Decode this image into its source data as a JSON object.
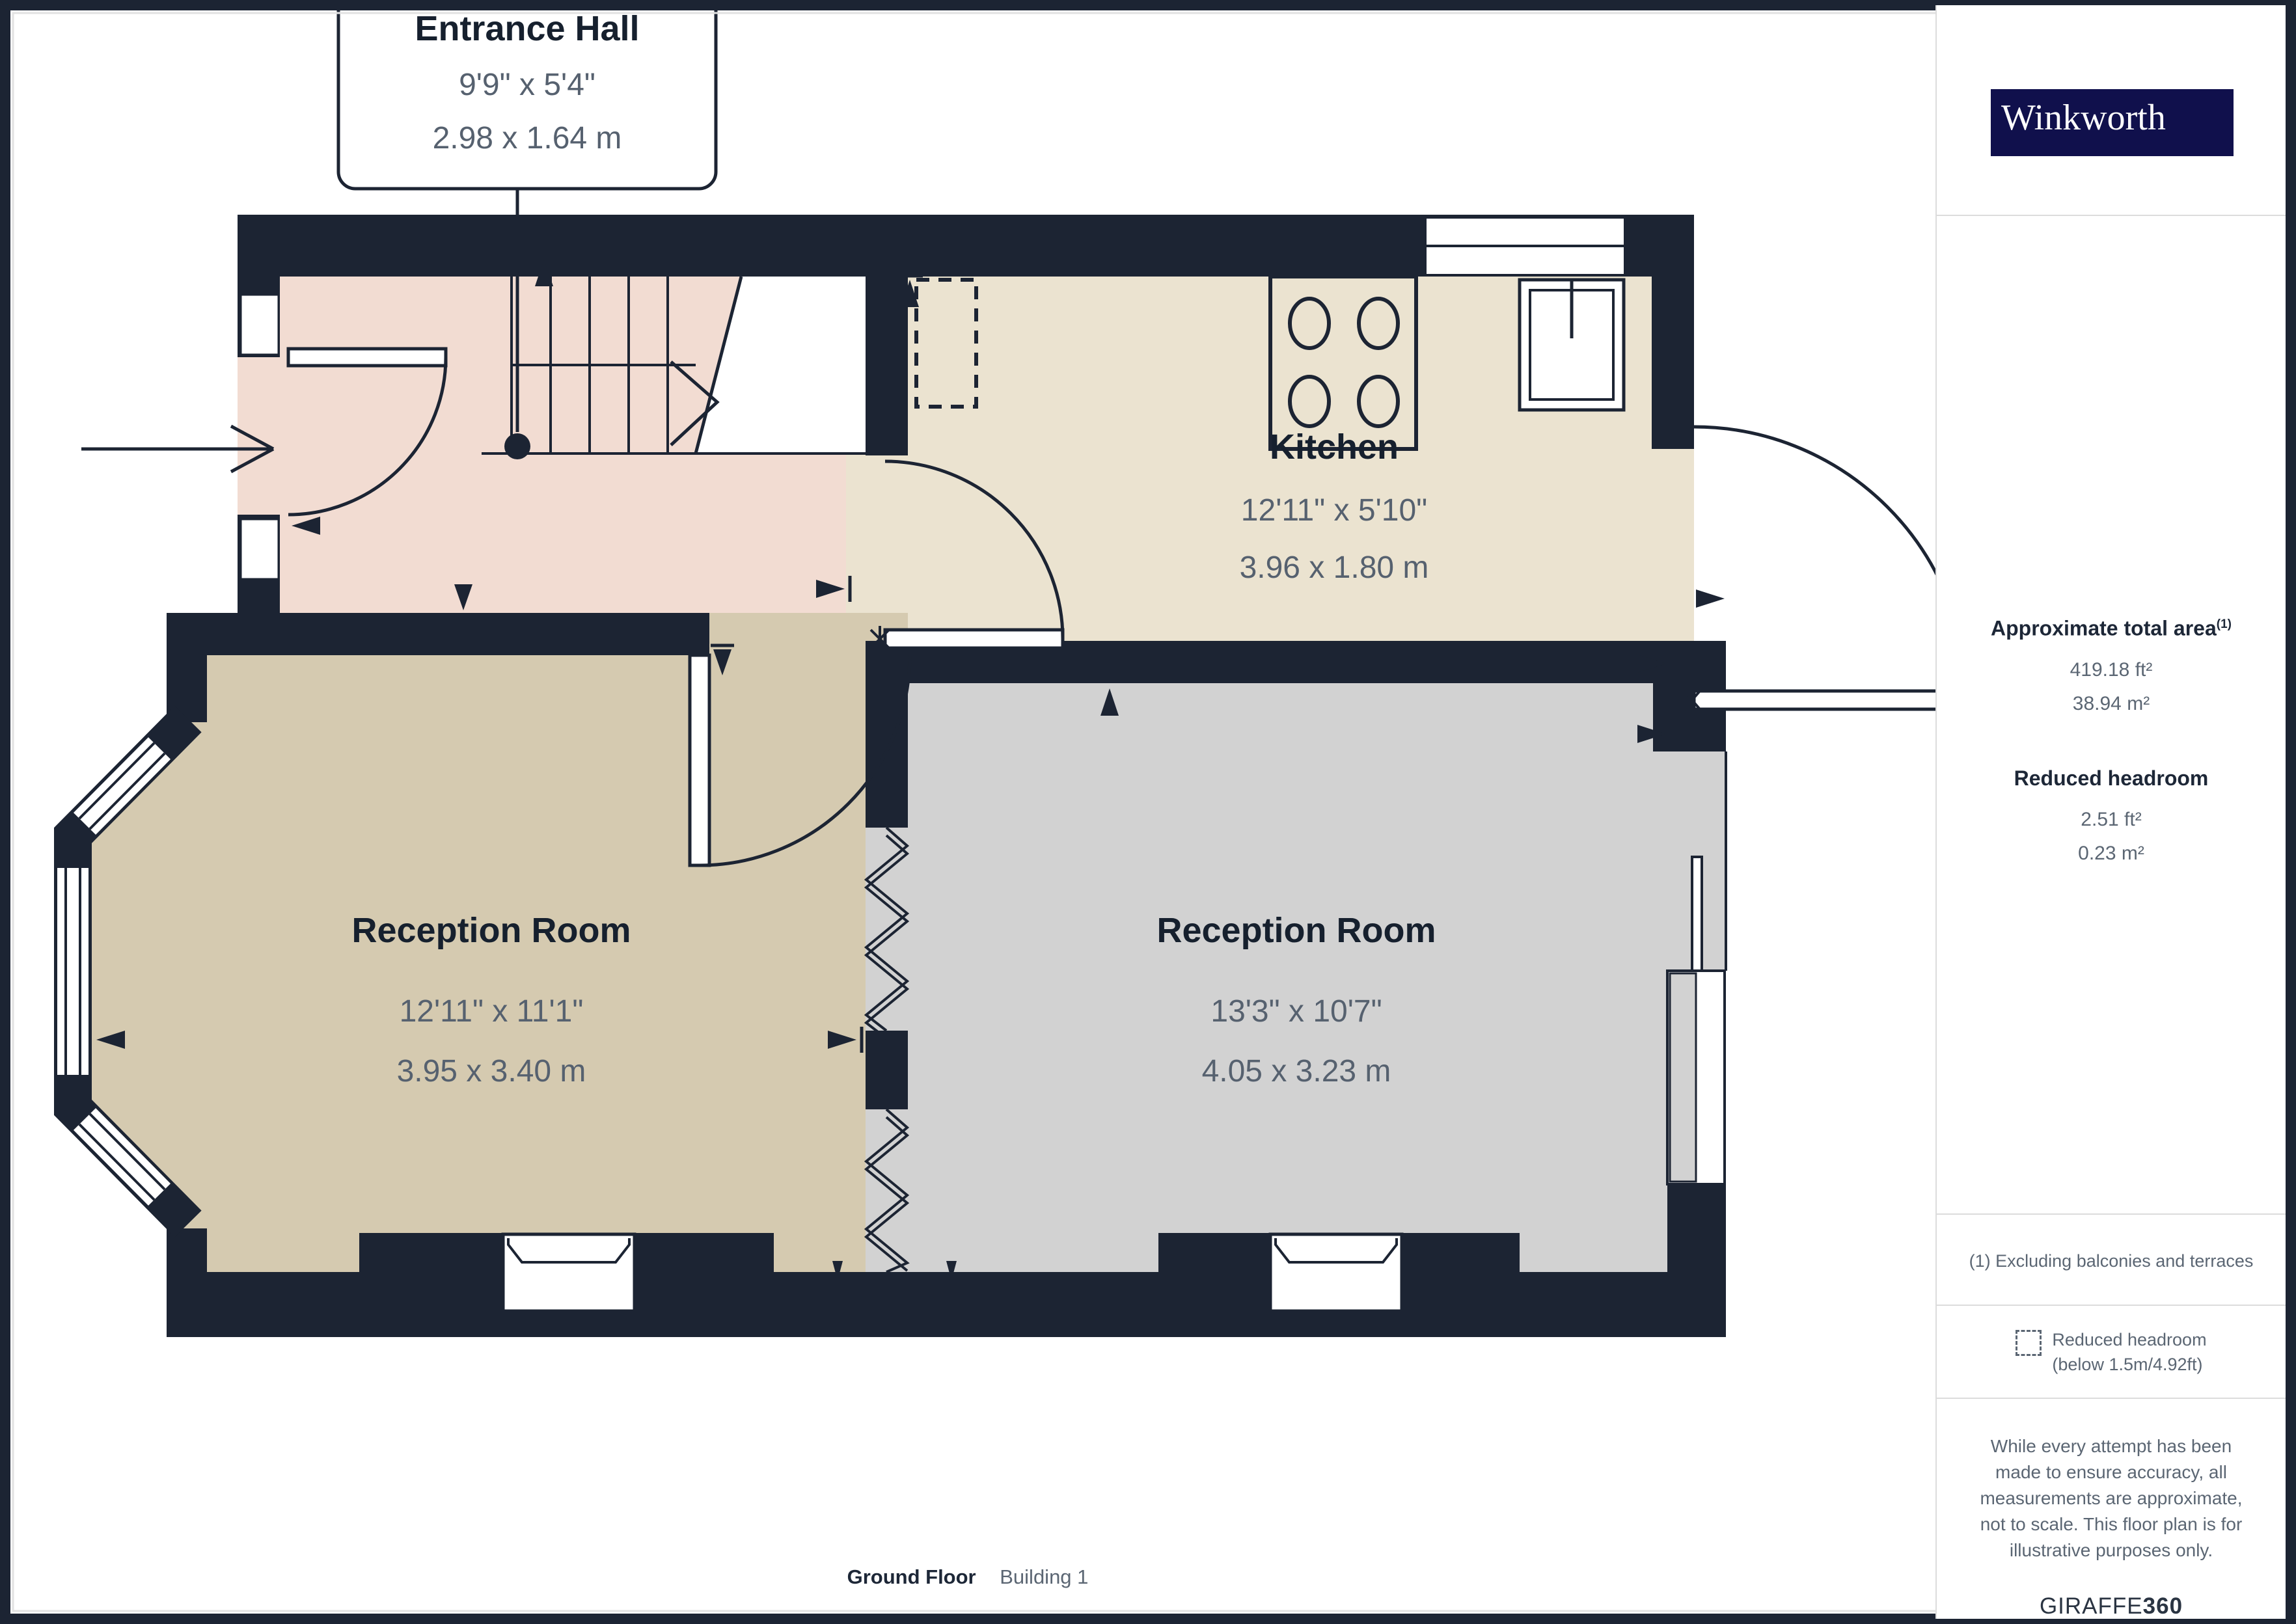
{
  "callout": {
    "room": "Entrance Hall",
    "imperial": "9'9\" x 5'4\"",
    "metric": "2.98 x 1.64 m"
  },
  "rooms": [
    {
      "name": "Kitchen",
      "imperial": "12'11\" x 5'10\"",
      "metric": "3.96 x 1.80 m"
    },
    {
      "name": "Reception Room",
      "imperial": "12'11\" x 11'1\"",
      "metric": "3.95 x 3.40 m"
    },
    {
      "name": "Reception Room",
      "imperial": "13'3\" x 10'7\"",
      "metric": "4.05 x 3.23 m"
    }
  ],
  "sidebar": {
    "brand": "Winkworth",
    "total_area": {
      "heading": "Approximate total area",
      "footnote_mark": "(1)",
      "imperial": "419.18 ft²",
      "metric": "38.94 m²"
    },
    "reduced_headroom": {
      "heading": "Reduced headroom",
      "imperial": "2.51 ft²",
      "metric": "0.23 m²"
    },
    "footnote": "(1) Excluding balconies and terraces",
    "legend": {
      "line1": "Reduced headroom",
      "line2": "(below 1.5m/4.92ft)"
    },
    "disclaimer": "While every attempt has been made to ensure accuracy, all measurements are approximate, not to scale. This floor plan is for illustrative purposes only.",
    "provider": {
      "name": "GIRAFFE",
      "suffix": "360"
    }
  },
  "footer": {
    "floor_label": "Ground Floor",
    "building_label": "Building 1"
  },
  "colors": {
    "wall": "#1c2433",
    "hall": "#f2dcd2",
    "kitchen": "#ebe3d0",
    "reception_left": "#d5cab0",
    "reception_right": "#d2d2d2",
    "brand_navy": "#10104c",
    "heading": "#1d2737",
    "muted": "#5b6673"
  }
}
